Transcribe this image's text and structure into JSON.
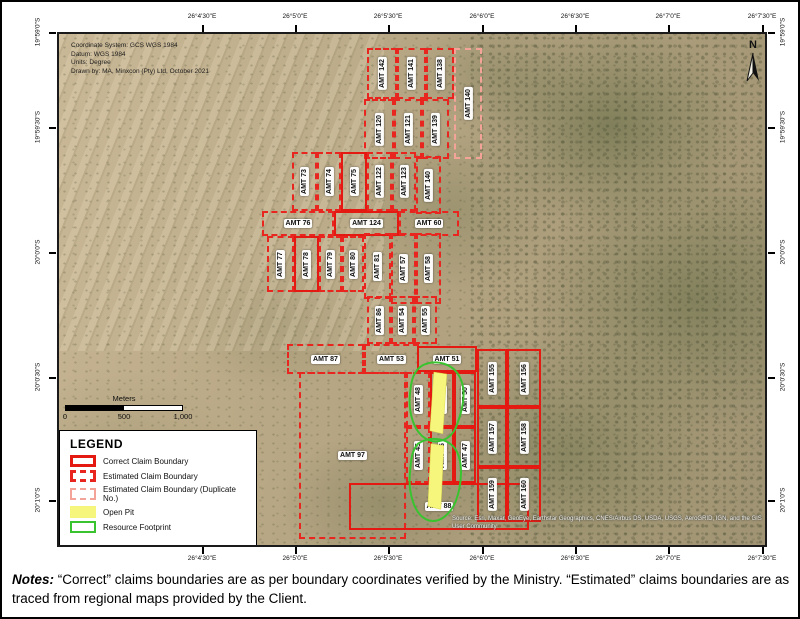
{
  "map": {
    "info_lines": [
      "Coordinate System: GCS WGS 1984",
      "Datum: WGS 1984",
      "Units: Degree",
      "Drawn by: MA, Minxcon (Pty) Ltd, October 2021"
    ],
    "north_label": "N",
    "attribution": "Source: Esri, Maxar, GeoEye, Earthstar Geographics, CNES/Airbus DS, USDA, USGS, AeroGRID, IGN, and the GIS User Community",
    "claims": [
      {
        "label": "AMT 142",
        "style": "dashed",
        "orient": "v",
        "x": 308,
        "y": 14,
        "w": 30,
        "h": 51
      },
      {
        "label": "AMT 141",
        "style": "dashed",
        "orient": "v",
        "x": 338,
        "y": 14,
        "w": 29,
        "h": 51
      },
      {
        "label": "AMT 138",
        "style": "dashed",
        "orient": "v",
        "x": 367,
        "y": 14,
        "w": 28,
        "h": 51
      },
      {
        "label": "AMT 140",
        "style": "dup",
        "orient": "v",
        "x": 395,
        "y": 14,
        "w": 28,
        "h": 111
      },
      {
        "label": "AMT 120",
        "style": "dashed",
        "orient": "v",
        "x": 305,
        "y": 65,
        "w": 30,
        "h": 60
      },
      {
        "label": "AMT 121",
        "style": "dashed",
        "orient": "v",
        "x": 335,
        "y": 65,
        "w": 28,
        "h": 60
      },
      {
        "label": "AMT 139",
        "style": "dashed",
        "orient": "v",
        "x": 363,
        "y": 65,
        "w": 27,
        "h": 60
      },
      {
        "label": "AMT 73",
        "style": "dashed",
        "orient": "v",
        "x": 233,
        "y": 118,
        "w": 25,
        "h": 59
      },
      {
        "label": "AMT 74",
        "style": "dashed",
        "orient": "v",
        "x": 258,
        "y": 118,
        "w": 24,
        "h": 59
      },
      {
        "label": "AMT 75",
        "style": "solid",
        "orient": "v",
        "x": 282,
        "y": 118,
        "w": 26,
        "h": 59
      },
      {
        "label": "AMT 122",
        "style": "dashed",
        "orient": "v",
        "x": 308,
        "y": 118,
        "w": 25,
        "h": 59
      },
      {
        "label": "AMT 123",
        "style": "dashed",
        "orient": "v",
        "x": 333,
        "y": 118,
        "w": 24,
        "h": 59
      },
      {
        "label": "AMT 140",
        "style": "dashed",
        "orient": "v",
        "x": 357,
        "y": 122,
        "w": 25,
        "h": 58
      },
      {
        "label": "AMT 76",
        "style": "dashed",
        "orient": "h",
        "x": 203,
        "y": 177,
        "w": 72,
        "h": 25
      },
      {
        "label": "AMT 124",
        "style": "solid",
        "orient": "h",
        "x": 275,
        "y": 177,
        "w": 65,
        "h": 25
      },
      {
        "label": "AMT 60",
        "style": "dashed",
        "orient": "h",
        "x": 340,
        "y": 177,
        "w": 60,
        "h": 25
      },
      {
        "label": "AMT 77",
        "style": "dashed",
        "orient": "v",
        "x": 208,
        "y": 202,
        "w": 27,
        "h": 56
      },
      {
        "label": "AMT 78",
        "style": "solid",
        "orient": "v",
        "x": 235,
        "y": 202,
        "w": 25,
        "h": 56
      },
      {
        "label": "AMT 79",
        "style": "dashed",
        "orient": "v",
        "x": 260,
        "y": 202,
        "w": 23,
        "h": 56
      },
      {
        "label": "AMT 80",
        "style": "dashed",
        "orient": "v",
        "x": 283,
        "y": 202,
        "w": 22,
        "h": 56
      },
      {
        "label": "AMT 81",
        "style": "dashed",
        "orient": "v",
        "x": 305,
        "y": 199,
        "w": 27,
        "h": 66
      },
      {
        "label": "AMT 57",
        "style": "dashed",
        "orient": "v",
        "x": 332,
        "y": 199,
        "w": 25,
        "h": 71
      },
      {
        "label": "AMT 58",
        "style": "dashed",
        "orient": "v",
        "x": 357,
        "y": 199,
        "w": 25,
        "h": 71
      },
      {
        "label": "AMT 86",
        "style": "dashed",
        "orient": "v",
        "x": 308,
        "y": 262,
        "w": 24,
        "h": 48
      },
      {
        "label": "AMT 54",
        "style": "dashed",
        "orient": "v",
        "x": 332,
        "y": 262,
        "w": 23,
        "h": 48
      },
      {
        "label": "AMT 55",
        "style": "dashed",
        "orient": "v",
        "x": 355,
        "y": 262,
        "w": 23,
        "h": 48
      },
      {
        "label": "AMT 87",
        "style": "dashed",
        "orient": "h",
        "x": 228,
        "y": 310,
        "w": 77,
        "h": 30
      },
      {
        "label": "AMT 53",
        "style": "dashed",
        "orient": "h",
        "x": 305,
        "y": 310,
        "w": 55,
        "h": 30
      },
      {
        "label": "AMT 51",
        "style": "solid",
        "orient": "h",
        "x": 358,
        "y": 312,
        "w": 60,
        "h": 26
      },
      {
        "label": "AMT 97",
        "style": "dashed",
        "orient": "h",
        "x": 240,
        "y": 338,
        "w": 107,
        "h": 167
      },
      {
        "label": "AMT 48",
        "style": "dashed",
        "orient": "v",
        "x": 347,
        "y": 338,
        "w": 24,
        "h": 55
      },
      {
        "label": "AMT 49",
        "style": "solid",
        "orient": "v",
        "x": 371,
        "y": 338,
        "w": 24,
        "h": 55
      },
      {
        "label": "AMT 50",
        "style": "solid",
        "orient": "v",
        "x": 395,
        "y": 338,
        "w": 22,
        "h": 55
      },
      {
        "label": "AMT 45",
        "style": "dashed",
        "orient": "v",
        "x": 347,
        "y": 393,
        "w": 24,
        "h": 56
      },
      {
        "label": "AMT 46",
        "style": "solid",
        "orient": "v",
        "x": 371,
        "y": 393,
        "w": 24,
        "h": 56
      },
      {
        "label": "AMT 47",
        "style": "solid",
        "orient": "v",
        "x": 395,
        "y": 393,
        "w": 22,
        "h": 56
      },
      {
        "label": "AMT 88",
        "style": "solid",
        "orient": "h",
        "x": 290,
        "y": 449,
        "w": 180,
        "h": 47
      },
      {
        "label": "AMT 155",
        "style": "solid",
        "orient": "v",
        "x": 418,
        "y": 315,
        "w": 30,
        "h": 58
      },
      {
        "label": "AMT 156",
        "style": "solid",
        "orient": "v",
        "x": 448,
        "y": 315,
        "w": 34,
        "h": 58
      },
      {
        "label": "AMT 157",
        "style": "solid",
        "orient": "v",
        "x": 418,
        "y": 373,
        "w": 30,
        "h": 60
      },
      {
        "label": "AMT 158",
        "style": "solid",
        "orient": "v",
        "x": 448,
        "y": 373,
        "w": 34,
        "h": 60
      },
      {
        "label": "AMT 159",
        "style": "solid",
        "orient": "v",
        "x": 418,
        "y": 433,
        "w": 30,
        "h": 55
      },
      {
        "label": "AMT 160",
        "style": "solid",
        "orient": "v",
        "x": 448,
        "y": 433,
        "w": 34,
        "h": 55
      }
    ]
  },
  "axes": {
    "lon_ticks": [
      {
        "label": "26°4'30\"E",
        "x": 200
      },
      {
        "label": "26°5'0\"E",
        "x": 293
      },
      {
        "label": "26°5'30\"E",
        "x": 386
      },
      {
        "label": "26°6'0\"E",
        "x": 480
      },
      {
        "label": "26°6'30\"E",
        "x": 573
      },
      {
        "label": "26°7'0\"E",
        "x": 666
      },
      {
        "label": "26°7'30\"E",
        "x": 760
      }
    ],
    "lat_ticks": [
      {
        "label": "19°59'0\"S",
        "y": 30
      },
      {
        "label": "19°59'30\"S",
        "y": 125
      },
      {
        "label": "20°0'0\"S",
        "y": 250
      },
      {
        "label": "20°0'30\"S",
        "y": 375
      },
      {
        "label": "20°1'0\"S",
        "y": 498
      }
    ]
  },
  "scalebar": {
    "title": "Meters",
    "labels": [
      "0",
      "500",
      "1,000"
    ]
  },
  "legend": {
    "title": "LEGEND",
    "items": [
      {
        "label": "Correct Claim Boundary",
        "swatch": "solid"
      },
      {
        "label": "Estimated Claim Boundary",
        "swatch": "dashed"
      },
      {
        "label": "Estimated Claim Boundary (Duplicate No.)",
        "swatch": "dup"
      },
      {
        "label": "Open Pit",
        "swatch": "pit"
      },
      {
        "label": "Resource Footprint",
        "swatch": "foot"
      }
    ]
  },
  "notes": {
    "label": "Notes:",
    "text": "“Correct” claims boundaries are as per boundary coordinates verified by the Ministry. “Estimated” claims boundaries are as traced from regional maps provided by the Client."
  },
  "colors": {
    "boundary_correct": "#e41a12",
    "boundary_estimated": "#e8261f",
    "boundary_duplicate": "#f4a398",
    "open_pit": "#f6f67c",
    "resource_footprint": "#39c42f"
  }
}
